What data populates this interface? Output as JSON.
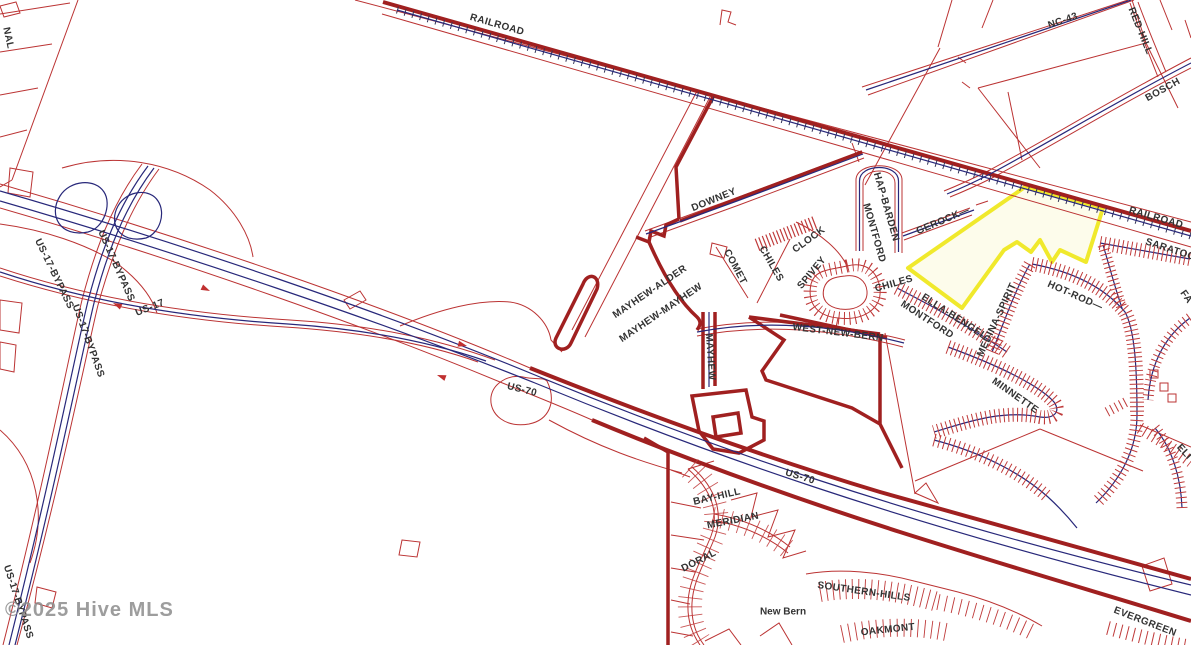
{
  "map": {
    "city": "New Bern",
    "watermark": "©2025 Hive MLS",
    "colors": {
      "background": "#ffffff",
      "parcel_line": "#bb3333",
      "boundary_thick": "#a02020",
      "road_centerline": "#28287a",
      "railroad_hatch": "#333355",
      "label": "#333333",
      "watermark": "#8d8d8d",
      "highlight_border": "#f0e92c",
      "highlight_fill": "#fdfceb"
    },
    "highlighted_parcel": {
      "border_color": "#f0e92c",
      "fill_color": "#fdfceb"
    },
    "labels": [
      {
        "text": "RAILROAD",
        "x": 497,
        "y": 25,
        "rot": 16
      },
      {
        "text": "RAILROAD",
        "x": 1156,
        "y": 218,
        "rot": 16
      },
      {
        "text": "NC-43",
        "x": 1063,
        "y": 21,
        "rot": -19
      },
      {
        "text": "RED-HILL",
        "x": 1140,
        "y": 31,
        "rot": 68,
        "size": 9.5
      },
      {
        "text": "BOSCH",
        "x": 1163,
        "y": 90,
        "rot": -29
      },
      {
        "text": "DOWNEY",
        "x": 714,
        "y": 200,
        "rot": -22
      },
      {
        "text": "HAP-BARDEN",
        "x": 886,
        "y": 207,
        "rot": 74,
        "size": 9.5
      },
      {
        "text": "MONTFORD",
        "x": 874,
        "y": 233,
        "rot": 74,
        "size": 9.5
      },
      {
        "text": "GEROCK—",
        "x": 943,
        "y": 221,
        "rot": -23
      },
      {
        "text": "COMET",
        "x": 735,
        "y": 267,
        "rot": 62
      },
      {
        "text": "CHILES",
        "x": 771,
        "y": 264,
        "rot": 60
      },
      {
        "text": "CLOCK",
        "x": 809,
        "y": 240,
        "rot": -36
      },
      {
        "text": "SPIVEY",
        "x": 812,
        "y": 273,
        "rot": -50
      },
      {
        "text": "WEST-NEW-BERN",
        "x": 838,
        "y": 333,
        "rot": 7
      },
      {
        "text": "CHILES",
        "x": 894,
        "y": 284,
        "rot": -16,
        "size": 9.5
      },
      {
        "text": "MONTFORD",
        "x": 927,
        "y": 320,
        "rot": 33,
        "size": 9.5
      },
      {
        "text": "ELLA-BENGEL",
        "x": 954,
        "y": 317,
        "rot": 33,
        "size": 9.5
      },
      {
        "text": "MEDINA-SPIRIT",
        "x": 997,
        "y": 320,
        "rot": -65,
        "size": 9.5
      },
      {
        "text": "HOT-ROD—",
        "x": 1075,
        "y": 296,
        "rot": 24,
        "size": 9.5
      },
      {
        "text": "MINNETTE",
        "x": 1015,
        "y": 396,
        "rot": 35,
        "size": 9.5
      },
      {
        "text": "SARATOGA",
        "x": 1174,
        "y": 251,
        "rot": 18,
        "size": 9.5
      },
      {
        "text": "FA",
        "x": 1186,
        "y": 297,
        "rot": 55,
        "size": 9
      },
      {
        "text": "MAYHEW-ALDER",
        "x": 650,
        "y": 292,
        "rot": -34,
        "size": 9.5
      },
      {
        "text": "MAYHEW-MAYHEW",
        "x": 661,
        "y": 313,
        "rot": -34,
        "size": 9.5
      },
      {
        "text": "MAYHEW",
        "x": 710,
        "y": 357,
        "rot": 86,
        "size": 9.5
      },
      {
        "text": "US-17-BYPASS",
        "x": 54,
        "y": 274,
        "rot": 64
      },
      {
        "text": "US-17-BYPASS",
        "x": 88,
        "y": 341,
        "rot": 70
      },
      {
        "text": "US-17-BYPASS",
        "x": 116,
        "y": 266,
        "rot": 66
      },
      {
        "text": "US-17-BYPASS",
        "x": 18,
        "y": 602,
        "rot": 72
      },
      {
        "text": "US-17",
        "x": 150,
        "y": 308,
        "rot": -22
      },
      {
        "text": "US-70",
        "x": 522,
        "y": 390,
        "rot": 14
      },
      {
        "text": "US-70",
        "x": 800,
        "y": 477,
        "rot": 17
      },
      {
        "text": "EVERGREEN",
        "x": 1145,
        "y": 622,
        "rot": 21
      },
      {
        "text": "BAY-HILL",
        "x": 717,
        "y": 497,
        "rot": -13,
        "size": 9.5
      },
      {
        "text": "MERIDIAN",
        "x": 733,
        "y": 521,
        "rot": -11
      },
      {
        "text": "DORAL",
        "x": 699,
        "y": 561,
        "rot": -27
      },
      {
        "text": "SOUTHERN-HILLS",
        "x": 864,
        "y": 592,
        "rot": 8
      },
      {
        "text": "OAKMONT",
        "x": 888,
        "y": 630,
        "rot": -6
      },
      {
        "text": "ELI",
        "x": 1184,
        "y": 452,
        "rot": 48,
        "size": 9
      },
      {
        "text": "NAL",
        "x": 8,
        "y": 38,
        "rot": 78,
        "size": 9,
        "color": "#bb3333"
      },
      {
        "text": "New Bern",
        "x": 783,
        "y": 612,
        "rot": 0,
        "size": 17,
        "color": "#000000",
        "bold": true
      }
    ]
  }
}
